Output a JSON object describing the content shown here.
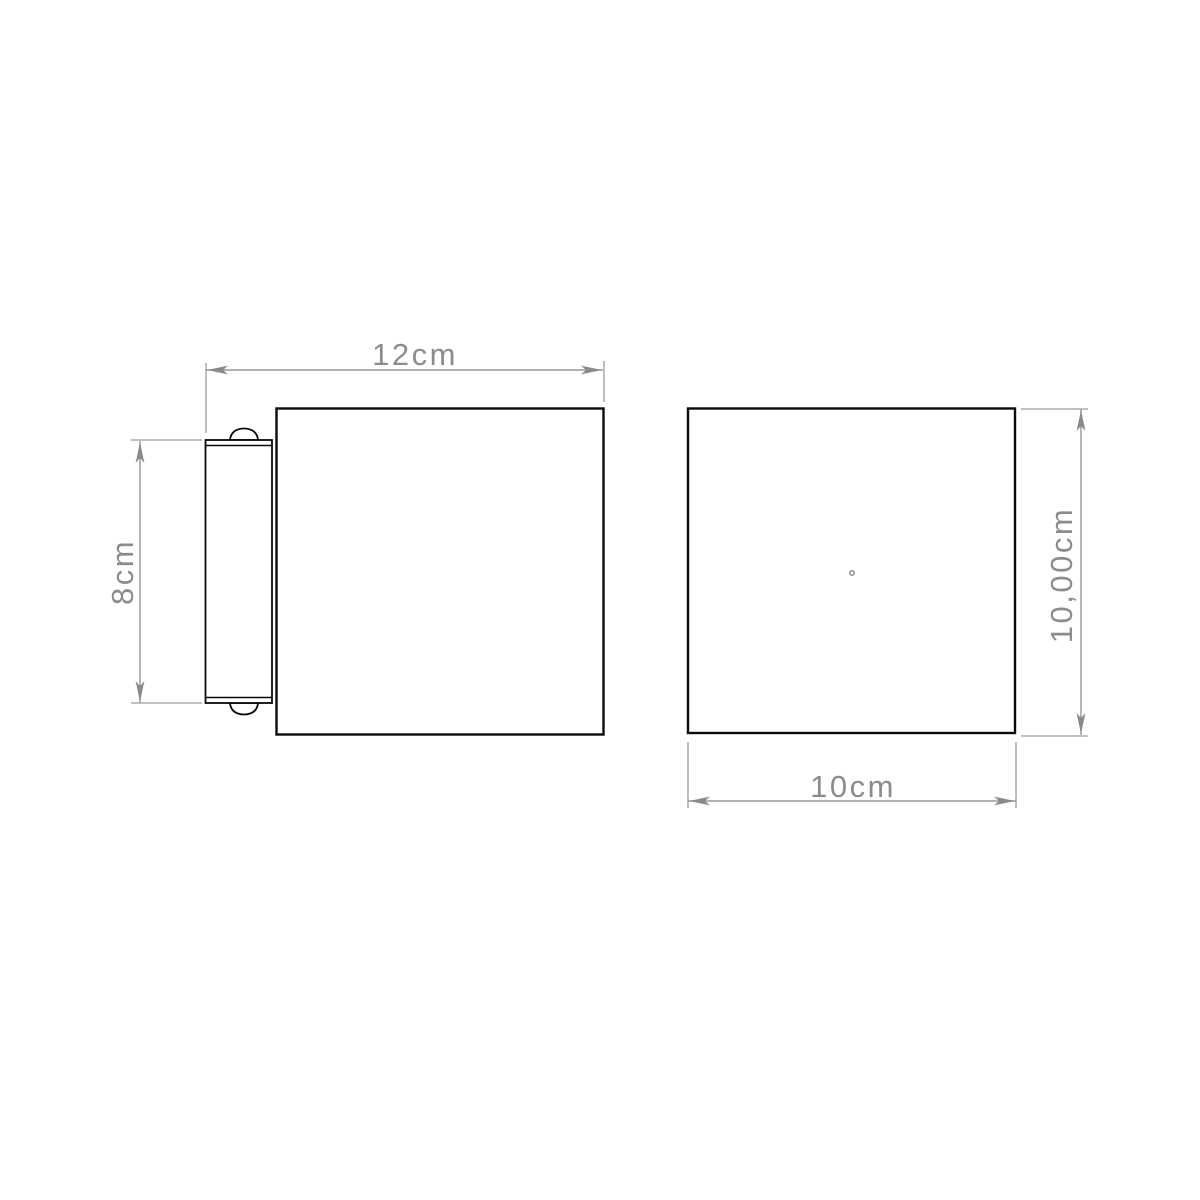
{
  "drawing": {
    "type": "technical-drawing",
    "subject": "two-view dimension drawing of a cube wall lamp with mounting bracket",
    "background_color": "#ffffff",
    "colors": {
      "part_outline": "#0a0a0a",
      "dimension_lines": "#979797",
      "dimension_text": "#8c8c8c"
    },
    "views": {
      "side": {
        "name": "side view with mounting bracket and screws",
        "dimensions": [
          {
            "id": "overall-depth",
            "label": "12cm",
            "orientation": "horizontal",
            "position": "top"
          },
          {
            "id": "bracket-height",
            "label": "8cm",
            "orientation": "vertical",
            "position": "left"
          }
        ]
      },
      "front": {
        "name": "front view square face with center point",
        "dimensions": [
          {
            "id": "height",
            "label": "10,00cm",
            "orientation": "vertical",
            "position": "right"
          },
          {
            "id": "width",
            "label": "10cm",
            "orientation": "horizontal",
            "position": "bottom"
          }
        ]
      }
    }
  }
}
